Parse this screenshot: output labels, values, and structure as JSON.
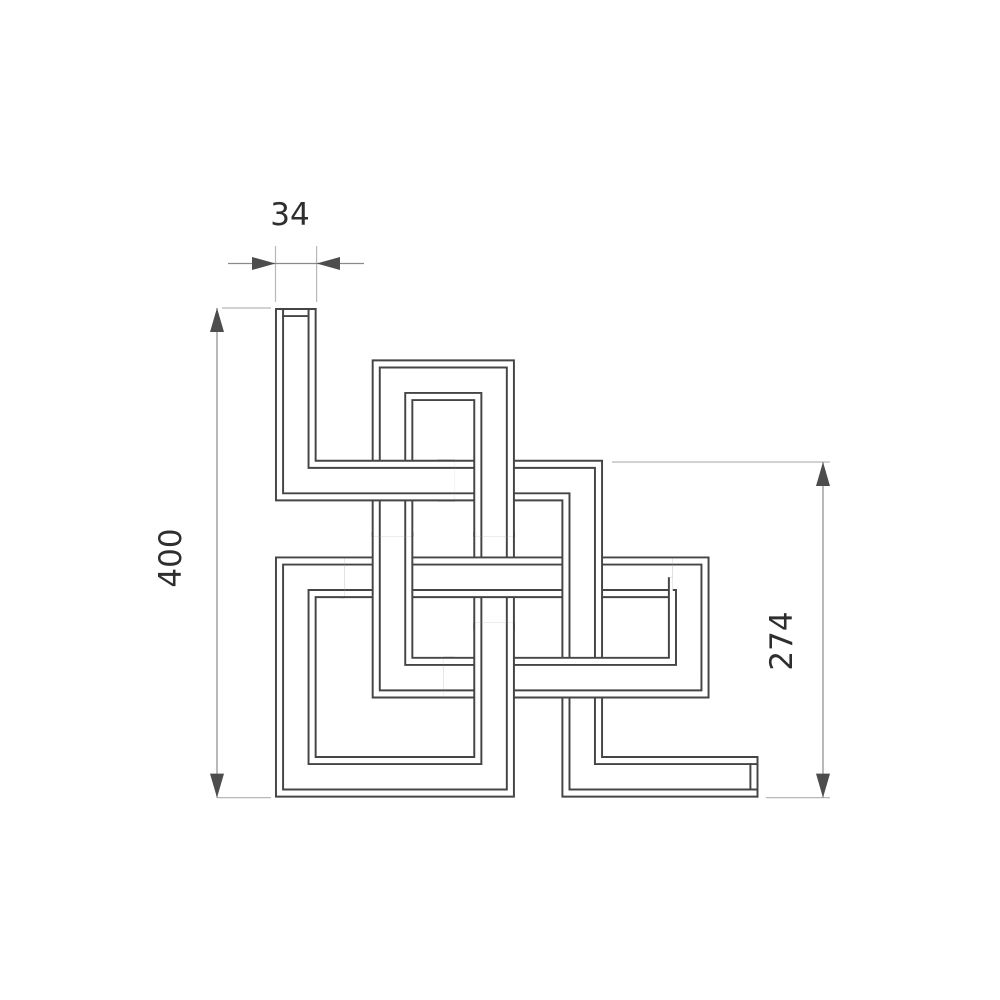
{
  "drawing": {
    "title": "woven-tube-radiator-profile",
    "line_color": "#454545",
    "background_color": "#ffffff",
    "dimensions": {
      "tube_width": {
        "label": "34"
      },
      "total_height": {
        "label": "400"
      },
      "right_height": {
        "label": "274"
      }
    },
    "tube": {
      "width_units": 34,
      "wall_inset_units": 5.8,
      "scale_px_per_unit": 1.224,
      "origin_px": {
        "x": 275,
        "y": 308
      }
    },
    "strokes": [
      {
        "color": "line",
        "w": 34
      },
      {
        "color": "white",
        "w": 30.8
      },
      {
        "color": "line",
        "w": 22.4
      },
      {
        "color": "white",
        "w": 19.2
      }
    ],
    "pieces": [
      {
        "id": "c3-mid-under-r3",
        "points": [
          [
            179,
            183
          ],
          [
            179,
            263
          ]
        ]
      },
      {
        "id": "r3-main-run",
        "points": [
          [
            330,
            220
          ],
          [
            53,
            220
          ]
        ]
      },
      {
        "id": "c2-lower-to-r4",
        "points": [
          [
            96,
            183
          ],
          [
            96,
            302
          ],
          [
            147,
            302
          ]
        ]
      },
      {
        "id": "open-tube-r2-c4-r5-end",
        "points": [
          [
            133,
            141
          ],
          [
            251,
            141
          ],
          [
            251,
            383
          ],
          [
            395,
            383
          ]
        ]
      },
      {
        "id": "r4-c5-r3-east",
        "points": [
          [
            138,
            302
          ],
          [
            338,
            302
          ],
          [
            338,
            220
          ],
          [
            325,
            220
          ]
        ]
      },
      {
        "id": "r3-west-c1-lower-r5-west-c3",
        "points": [
          [
            57,
            220
          ],
          [
            17,
            220
          ],
          [
            17,
            383
          ],
          [
            179,
            383
          ],
          [
            179,
            257
          ]
        ]
      },
      {
        "id": "c3-top-r1-arch-c2-upper",
        "points": [
          [
            179,
            187
          ],
          [
            179,
            59
          ],
          [
            96,
            59
          ],
          [
            96,
            187
          ]
        ]
      },
      {
        "id": "open-tube-start-c1-r2-west",
        "points": [
          [
            17,
            0
          ],
          [
            17,
            141
          ],
          [
            147,
            141
          ]
        ]
      }
    ],
    "end_caps": [
      {
        "x1": 0,
        "y1": 0.8,
        "x2": 34,
        "y2": 0.8
      },
      {
        "x1": 5.8,
        "y1": 6.6,
        "x2": 28.2,
        "y2": 6.6
      },
      {
        "x1": 394.2,
        "y1": 366,
        "x2": 394.2,
        "y2": 400
      },
      {
        "x1": 388.4,
        "y1": 371.8,
        "x2": 388.4,
        "y2": 394.2
      }
    ],
    "cap_stroke_w": 1.6
  }
}
